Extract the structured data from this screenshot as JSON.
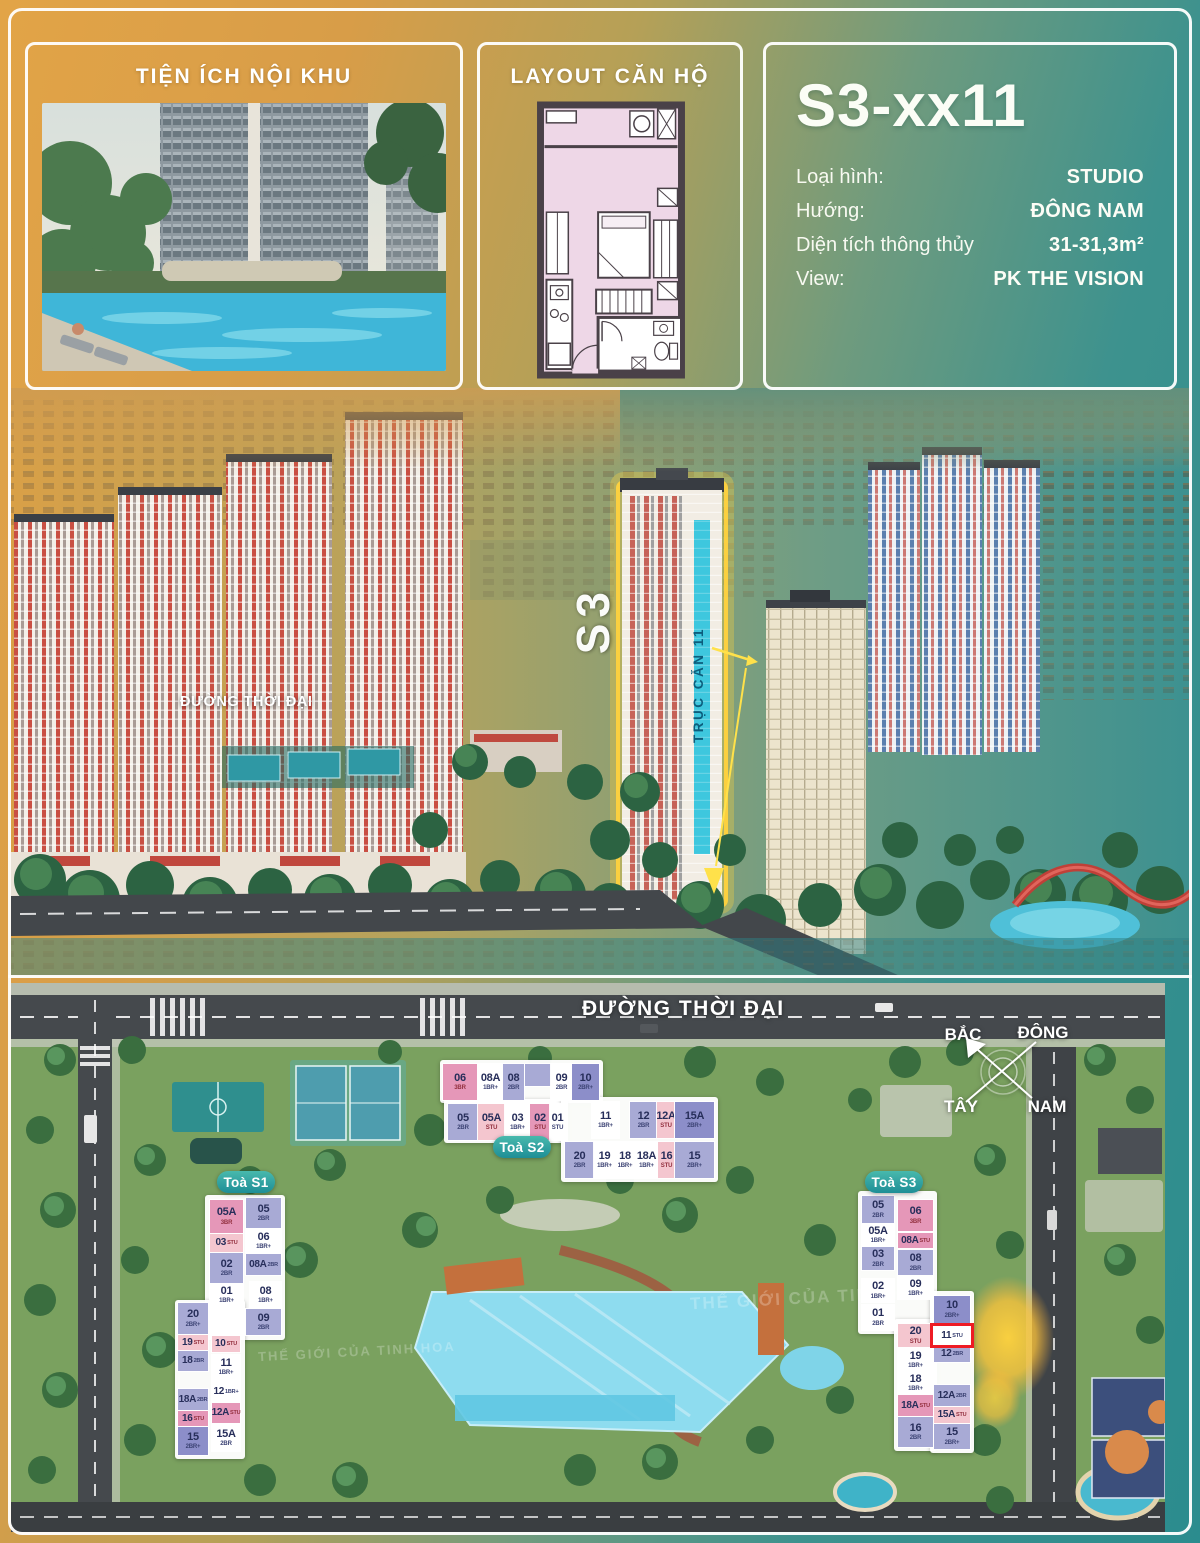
{
  "panels": {
    "amenities": {
      "title": "TIỆN ÍCH NỘI KHU"
    },
    "layout": {
      "title": "LAYOUT CĂN HỘ"
    },
    "info": {
      "unit_code": "S3-xx11",
      "rows": [
        {
          "label": "Loại hình:",
          "value": "STUDIO"
        },
        {
          "label": "Hướng:",
          "value": "ĐÔNG NAM"
        },
        {
          "label": "Diện tích thông thủy",
          "value": "31-31,3m²"
        },
        {
          "label": "View:",
          "value": "PK THE VISION"
        }
      ]
    }
  },
  "aerial": {
    "road_label": "ĐƯỜNG THỜI ĐẠI",
    "tower_label": "S3",
    "axis_label": "TRỤC CĂN 11"
  },
  "siteplan": {
    "road_label": "ĐƯỜNG THỜI ĐẠI",
    "watermark": "THẾ GIỚI CỦA TINH HOA",
    "compass": {
      "north": "BẮC",
      "east": "ĐÔNG",
      "west": "TÂY",
      "south": "NAM"
    },
    "palette": {
      "lav": "#a8aad5",
      "dlav": "#8c8ec9",
      "white": "#ffffff",
      "pink": "#e597b8",
      "pinkL": "#f4c6cf"
    },
    "highlight_color": "#ee1b24",
    "towers": [
      {
        "key": "s1",
        "name": "Toà S1",
        "badge": {
          "x": 217,
          "y": 1171,
          "w": 58,
          "h": 22
        },
        "blocks": [
          {
            "x": 205,
            "y": 1195,
            "w": 80,
            "h": 145
          },
          {
            "x": 175,
            "y": 1300,
            "w": 70,
            "h": 159
          }
        ],
        "cells": [
          {
            "id": "05A",
            "t": "3BR",
            "c": "pink",
            "x": 210,
            "y": 1200,
            "w": 33,
            "h": 33
          },
          {
            "id": "03",
            "t": "STU",
            "c": "pinkL",
            "x": 210,
            "y": 1234,
            "w": 33,
            "h": 18
          },
          {
            "id": "02",
            "t": "2BR",
            "c": "lav",
            "x": 210,
            "y": 1253,
            "w": 33,
            "h": 30
          },
          {
            "id": "01",
            "t": "1BR+",
            "c": "white",
            "x": 210,
            "y": 1284,
            "w": 33,
            "h": 22
          },
          {
            "id": "05",
            "t": "2BR",
            "c": "lav",
            "x": 246,
            "y": 1198,
            "w": 35,
            "h": 30
          },
          {
            "id": "06",
            "t": "1BR+",
            "c": "white",
            "x": 246,
            "y": 1229,
            "w": 35,
            "h": 24
          },
          {
            "id": "08A",
            "t": "2BR",
            "c": "lav",
            "x": 246,
            "y": 1254,
            "w": 35,
            "h": 21
          },
          {
            "id": "08",
            "t": "1BR+",
            "c": "white",
            "x": 250,
            "y": 1282,
            "w": 31,
            "h": 26
          },
          {
            "id": "09",
            "t": "2BR",
            "c": "lav",
            "x": 246,
            "y": 1309,
            "w": 35,
            "h": 26
          },
          {
            "id": "20",
            "t": "2BR+",
            "c": "lav",
            "x": 178,
            "y": 1303,
            "w": 30,
            "h": 31
          },
          {
            "id": "19",
            "t": "STU",
            "c": "pinkL",
            "x": 178,
            "y": 1335,
            "w": 30,
            "h": 15
          },
          {
            "id": "18",
            "t": "2BR",
            "c": "lav",
            "x": 178,
            "y": 1351,
            "w": 30,
            "h": 20
          },
          {
            "id": "18A",
            "t": "2BR",
            "c": "lav",
            "x": 178,
            "y": 1389,
            "w": 30,
            "h": 21
          },
          {
            "id": "16",
            "t": "STU",
            "c": "pink",
            "x": 178,
            "y": 1411,
            "w": 30,
            "h": 15
          },
          {
            "id": "15",
            "t": "2BR+",
            "c": "dlav",
            "x": 178,
            "y": 1427,
            "w": 30,
            "h": 28
          },
          {
            "id": "10",
            "t": "STU",
            "c": "pinkL",
            "x": 212,
            "y": 1336,
            "w": 28,
            "h": 16
          },
          {
            "id": "11",
            "t": "1BR+",
            "c": "white",
            "x": 212,
            "y": 1355,
            "w": 28,
            "h": 24
          },
          {
            "id": "12",
            "t": "1BR+",
            "c": "white",
            "x": 212,
            "y": 1381,
            "w": 28,
            "h": 21
          },
          {
            "id": "12A",
            "t": "STU",
            "c": "pink",
            "x": 212,
            "y": 1403,
            "w": 28,
            "h": 20
          },
          {
            "id": "15A",
            "t": "2BR",
            "c": "white",
            "x": 212,
            "y": 1425,
            "w": 28,
            "h": 26
          }
        ]
      },
      {
        "key": "s2",
        "name": "Toà S2",
        "badge": {
          "x": 493,
          "y": 1136,
          "w": 58,
          "h": 22
        },
        "blocks": [
          {
            "x": 440,
            "y": 1060,
            "w": 163,
            "h": 43
          },
          {
            "x": 444,
            "y": 1099,
            "w": 124,
            "h": 44
          },
          {
            "x": 561,
            "y": 1097,
            "w": 157,
            "h": 85
          }
        ],
        "cells": [
          {
            "id": "06",
            "t": "3BR",
            "c": "pink",
            "x": 443,
            "y": 1064,
            "w": 34,
            "h": 36
          },
          {
            "id": "08A",
            "t": "1BR+",
            "c": "white",
            "x": 478,
            "y": 1064,
            "w": 25,
            "h": 36
          },
          {
            "id": "08",
            "t": "2BR",
            "c": "lav",
            "x": 503,
            "y": 1064,
            "w": 21,
            "h": 36
          },
          {
            "id": "",
            "t": "",
            "c": "lav",
            "x": 525,
            "y": 1064,
            "w": 26,
            "h": 22
          },
          {
            "id": "09",
            "t": "2BR",
            "c": "white",
            "x": 551,
            "y": 1064,
            "w": 21,
            "h": 36
          },
          {
            "id": "10",
            "t": "2BR+",
            "c": "dlav",
            "x": 572,
            "y": 1064,
            "w": 27,
            "h": 36
          },
          {
            "id": "05",
            "t": "2BR",
            "c": "lav",
            "x": 448,
            "y": 1104,
            "w": 30,
            "h": 36
          },
          {
            "id": "05A",
            "t": "STU",
            "c": "pinkL",
            "x": 478,
            "y": 1104,
            "w": 27,
            "h": 36
          },
          {
            "id": "03",
            "t": "1BR+",
            "c": "white",
            "x": 505,
            "y": 1104,
            "w": 25,
            "h": 36
          },
          {
            "id": "02",
            "t": "STU",
            "c": "pink",
            "x": 530,
            "y": 1104,
            "w": 20,
            "h": 36
          },
          {
            "id": "01",
            "t": "STU",
            "c": "white",
            "x": 550,
            "y": 1104,
            "w": 15,
            "h": 36
          },
          {
            "id": "11",
            "t": "1BR+",
            "c": "white",
            "x": 592,
            "y": 1102,
            "w": 27,
            "h": 36
          },
          {
            "id": "12",
            "t": "2BR",
            "c": "lav",
            "x": 630,
            "y": 1102,
            "w": 27,
            "h": 36
          },
          {
            "id": "12A",
            "t": "STU",
            "c": "pinkL",
            "x": 657,
            "y": 1102,
            "w": 18,
            "h": 36
          },
          {
            "id": "15A",
            "t": "2BR+",
            "c": "dlav",
            "x": 675,
            "y": 1102,
            "w": 39,
            "h": 36
          },
          {
            "id": "20",
            "t": "2BR",
            "c": "lav",
            "x": 565,
            "y": 1142,
            "w": 29,
            "h": 36
          },
          {
            "id": "19",
            "t": "1BR+",
            "c": "white",
            "x": 594,
            "y": 1142,
            "w": 21,
            "h": 36
          },
          {
            "id": "18",
            "t": "1BR+",
            "c": "white",
            "x": 615,
            "y": 1142,
            "w": 20,
            "h": 36
          },
          {
            "id": "18A",
            "t": "1BR+",
            "c": "white",
            "x": 635,
            "y": 1142,
            "w": 23,
            "h": 36
          },
          {
            "id": "16",
            "t": "STU",
            "c": "pinkL",
            "x": 658,
            "y": 1142,
            "w": 17,
            "h": 36
          },
          {
            "id": "15",
            "t": "2BR+",
            "c": "lav",
            "x": 675,
            "y": 1142,
            "w": 39,
            "h": 36
          }
        ]
      },
      {
        "key": "s3",
        "name": "Toà S3",
        "badge": {
          "x": 865,
          "y": 1171,
          "w": 58,
          "h": 22
        },
        "blocks": [
          {
            "x": 858,
            "y": 1191,
            "w": 79,
            "h": 143
          },
          {
            "x": 894,
            "y": 1319,
            "w": 43,
            "h": 132
          },
          {
            "x": 930,
            "y": 1291,
            "w": 44,
            "h": 162
          }
        ],
        "cells": [
          {
            "id": "05",
            "t": "2BR",
            "c": "lav",
            "x": 862,
            "y": 1196,
            "w": 32,
            "h": 27
          },
          {
            "id": "05A",
            "t": "1BR+",
            "c": "white",
            "x": 862,
            "y": 1224,
            "w": 32,
            "h": 22
          },
          {
            "id": "03",
            "t": "2BR",
            "c": "lav",
            "x": 862,
            "y": 1247,
            "w": 32,
            "h": 23
          },
          {
            "id": "02",
            "t": "1BR+",
            "c": "white",
            "x": 862,
            "y": 1279,
            "w": 32,
            "h": 23
          },
          {
            "id": "01",
            "t": "2BR",
            "c": "white",
            "x": 862,
            "y": 1305,
            "w": 32,
            "h": 25
          },
          {
            "id": "06",
            "t": "3BR",
            "c": "pink",
            "x": 898,
            "y": 1200,
            "w": 35,
            "h": 31
          },
          {
            "id": "08A",
            "t": "STU",
            "c": "pink",
            "x": 898,
            "y": 1233,
            "w": 35,
            "h": 15
          },
          {
            "id": "08",
            "t": "2BR",
            "c": "lav",
            "x": 898,
            "y": 1250,
            "w": 35,
            "h": 25
          },
          {
            "id": "09",
            "t": "1BR+",
            "c": "white",
            "x": 898,
            "y": 1277,
            "w": 35,
            "h": 22
          },
          {
            "id": "20",
            "t": "STU",
            "c": "pinkL",
            "x": 898,
            "y": 1324,
            "w": 35,
            "h": 23
          },
          {
            "id": "19",
            "t": "1BR+",
            "c": "white",
            "x": 898,
            "y": 1349,
            "w": 35,
            "h": 22
          },
          {
            "id": "18",
            "t": "1BR+",
            "c": "white",
            "x": 898,
            "y": 1372,
            "w": 35,
            "h": 22
          },
          {
            "id": "18A",
            "t": "STU",
            "c": "pink",
            "x": 898,
            "y": 1395,
            "w": 35,
            "h": 21
          },
          {
            "id": "16",
            "t": "2BR",
            "c": "lav",
            "x": 898,
            "y": 1417,
            "w": 35,
            "h": 30
          },
          {
            "id": "10",
            "t": "2BR+",
            "c": "dlav",
            "x": 934,
            "y": 1296,
            "w": 36,
            "h": 27
          },
          {
            "id": "11",
            "t": "STU",
            "c": "white",
            "x": 933,
            "y": 1326,
            "w": 38,
            "h": 19,
            "hl": true
          },
          {
            "id": "12",
            "t": "2BR",
            "c": "lav",
            "x": 934,
            "y": 1346,
            "w": 36,
            "h": 16
          },
          {
            "id": "12A",
            "t": "2BR",
            "c": "lav",
            "x": 934,
            "y": 1385,
            "w": 36,
            "h": 21
          },
          {
            "id": "15A",
            "t": "STU",
            "c": "pinkL",
            "x": 934,
            "y": 1407,
            "w": 36,
            "h": 16
          },
          {
            "id": "15",
            "t": "2BR+",
            "c": "lav",
            "x": 934,
            "y": 1424,
            "w": 36,
            "h": 25
          }
        ]
      }
    ]
  }
}
